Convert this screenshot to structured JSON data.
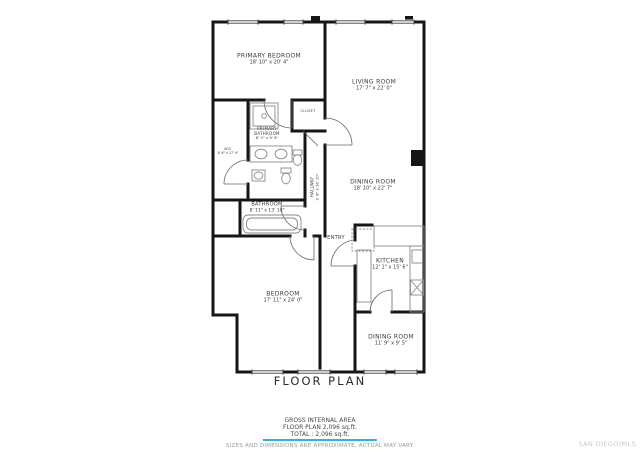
{
  "title": "FLOOR PLAN",
  "rooms": {
    "primary_bedroom": {
      "name": "PRIMARY BEDROOM",
      "dims": "18' 10\" x 20' 4\""
    },
    "living_room": {
      "name": "LIVING ROOM",
      "dims": "17' 7\" x 22' 0\""
    },
    "dining_room_upper": {
      "name": "DINING ROOM",
      "dims": "18' 10\" x 22' 7\""
    },
    "primary_bathroom": {
      "name": "PRIMARY BATHROOM",
      "dims": "8' 2\" x 9' 9\""
    },
    "wic": {
      "name": "WIC",
      "dims": "6' 6\" x 17' 9\""
    },
    "closet": {
      "name": "CLOSET",
      "dims": ""
    },
    "hallway": {
      "name": "HALLWAY",
      "dims": "3' 8\" x 16' 10\""
    },
    "bathroom": {
      "name": "BATHROOM",
      "dims": "8' 11\" x 13' 10\""
    },
    "entry": {
      "name": "ENTRY",
      "dims": ""
    },
    "bedroom": {
      "name": "BEDROOM",
      "dims": "17' 11\" x 24' 0\""
    },
    "kitchen": {
      "name": "KITCHEN",
      "dims": "12' 1\" x 15' 6\""
    },
    "dining_room_lower": {
      "name": "DINING ROOM",
      "dims": "11' 9\" x 9' 5\""
    }
  },
  "footer": {
    "area_heading": "GROSS INTERNAL AREA",
    "area_line": "FLOOR PLAN 2,096 sq.ft.",
    "total_line": "TOTAL :  2,096 sq.ft.",
    "disclaimer": "SIZES AND DIMENSIONS ARE APPROXIMATE, ACTUAL MAY VARY.",
    "accent_color": "#2bb3e6"
  },
  "watermark": "SAN DIEGO|MLS",
  "colors": {
    "wall": "#161616",
    "fixture": "#8a8a8a",
    "door": "#666666"
  }
}
